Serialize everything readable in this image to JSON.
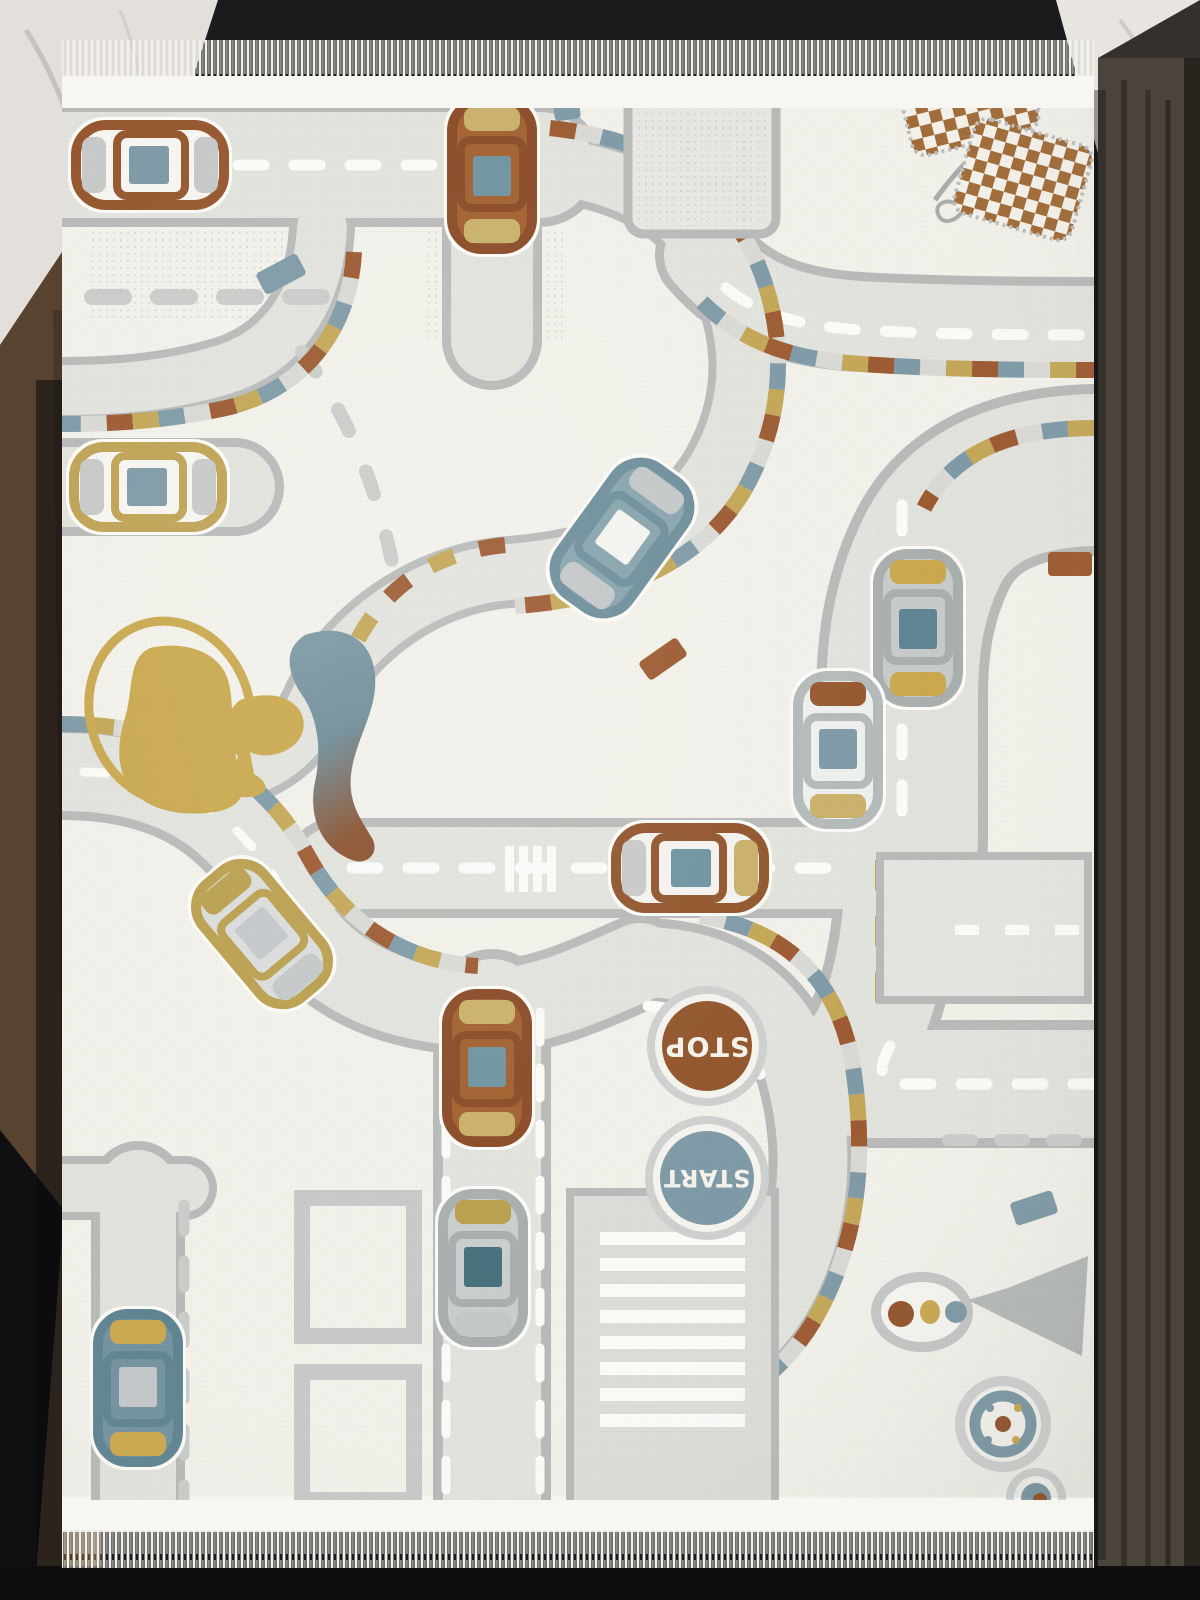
{
  "scene": {
    "caption": "Cream children's play rug with a gray race-track road network, top-view toy cars, STOP and START circles, crossed checkered racing flags and roundabout targets, displayed with white fringe between a white marble wall and dark wooden panels",
    "environment": {
      "wall": "white marble",
      "side_panels": "dark wood",
      "backdrop_color": "#1b1b1e"
    }
  },
  "rug": {
    "signs": {
      "stop": "STOP",
      "start": "START"
    },
    "fringe": "white tassels along top and bottom edges",
    "motifs": [
      "race-track roads with rust, blue and gold curb dashes",
      "top-view toy cars",
      "crossed checkered racing flags",
      "stop circle sign",
      "start circle sign",
      "gold splash with trophy",
      "roundabout target circles",
      "dotted paddle with goblet",
      "parking block with white bays",
      "outlined building blocks",
      "crosswalk stripes"
    ],
    "cars": [
      {
        "colors": "rust outline, white body, blue window",
        "location": "top left",
        "heading": "west"
      },
      {
        "colors": "rust body, gold hood, blue window",
        "location": "top center",
        "heading": "south"
      },
      {
        "colors": "gold outline, white body, blue window",
        "location": "mid left",
        "heading": "west"
      },
      {
        "colors": "steel-blue body, white windows",
        "location": "center, angled",
        "heading": "north-east"
      },
      {
        "colors": "gray body, gold bumpers, blue window",
        "location": "right of center",
        "heading": "south"
      },
      {
        "colors": "white body, rust hood, blue windows",
        "location": "right side, lower",
        "heading": "north"
      },
      {
        "colors": "rust outline, gold tail, blue window",
        "location": "center horizontal road",
        "heading": "east"
      },
      {
        "colors": "gold and gray body",
        "location": "left of center, angled",
        "heading": "north-east"
      },
      {
        "colors": "rust body, gold bumpers, blue window",
        "location": "lower center",
        "heading": "north"
      },
      {
        "colors": "gray body, gold stripe, teal window",
        "location": "bottom center",
        "heading": "north"
      },
      {
        "colors": "steel-blue body, gold accents",
        "location": "bottom left",
        "heading": "north"
      }
    ],
    "palette": {
      "field": "#f1f0e9",
      "road_fill": "#e2e2dd",
      "road_edge": "#b7bab8",
      "rust": "#9c5a31",
      "steel_blue": "#7e9aa6",
      "mustard": "#c3a656",
      "lane_dash": "#fafaf7",
      "fringe": "#f4f3ee",
      "stop_circle": "#91552c",
      "start_circle": "#7e9aa6",
      "flag_check": "#a06a36"
    }
  }
}
